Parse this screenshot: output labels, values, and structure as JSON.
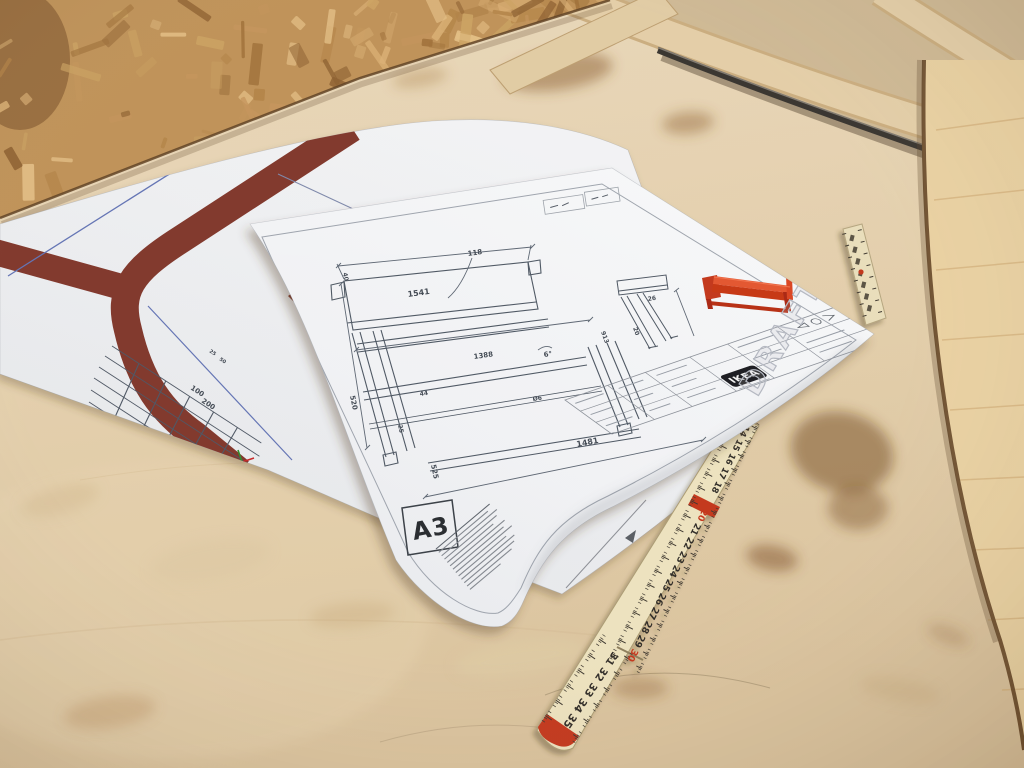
{
  "sheet_a3": {
    "format": "A3",
    "watermark": "DRAFT",
    "logo": "IKEA",
    "dims": {
      "top_width": "1541",
      "callout": "118",
      "mid_width": "1388",
      "angle": "6°",
      "bottom_width": "1481",
      "left_height": "520",
      "leg_height": "525",
      "d44": "44",
      "dia": "Ø6",
      "d25": "25",
      "side_depth": "913",
      "side_a": "26",
      "side_b": "20",
      "d40": "40"
    }
  },
  "sheet_template": {
    "scale_labels": [
      "25",
      "50",
      "100",
      "200"
    ]
  },
  "ruler": {
    "numbers": [
      {
        "v": "14",
        "cm": 0,
        "run": 1
      },
      {
        "v": "15",
        "cm": 1,
        "run": 1
      },
      {
        "v": "16",
        "cm": 2,
        "run": 1
      },
      {
        "v": "17",
        "cm": 3,
        "run": 1
      },
      {
        "v": "18",
        "cm": 4,
        "run": 1
      },
      {
        "v": "20",
        "cm": 6,
        "run": 1,
        "red": true
      },
      {
        "v": "21",
        "cm": 7,
        "run": 1
      },
      {
        "v": "22",
        "cm": 8,
        "run": 1
      },
      {
        "v": "23",
        "cm": 9,
        "run": 1
      },
      {
        "v": "24",
        "cm": 10,
        "run": 1
      },
      {
        "v": "25",
        "cm": 11,
        "run": 1
      },
      {
        "v": "26",
        "cm": 12,
        "run": 1
      },
      {
        "v": "27",
        "cm": 13,
        "run": 1
      },
      {
        "v": "28",
        "cm": 14,
        "run": 1
      },
      {
        "v": "29",
        "cm": 15,
        "run": 1
      },
      {
        "v": "30",
        "cm": 16,
        "run": 1,
        "red": true
      },
      {
        "v": "31",
        "cm": 0,
        "run": 2
      },
      {
        "v": "32",
        "cm": 1,
        "run": 2
      },
      {
        "v": "33",
        "cm": 2,
        "run": 2
      },
      {
        "v": "34",
        "cm": 3,
        "run": 2
      },
      {
        "v": "35",
        "cm": 4,
        "run": 2
      }
    ]
  },
  "colors": {
    "accent_red": "#d8411f",
    "stripe_maroon": "#7d3126",
    "paper": "#f2f3f5",
    "bench_wood": "#e3cfae",
    "osb": "#c2945c",
    "ruler_body": "#ece1bd",
    "ruler_red": "#c23018",
    "draft_gray": "#b2b6c0"
  }
}
